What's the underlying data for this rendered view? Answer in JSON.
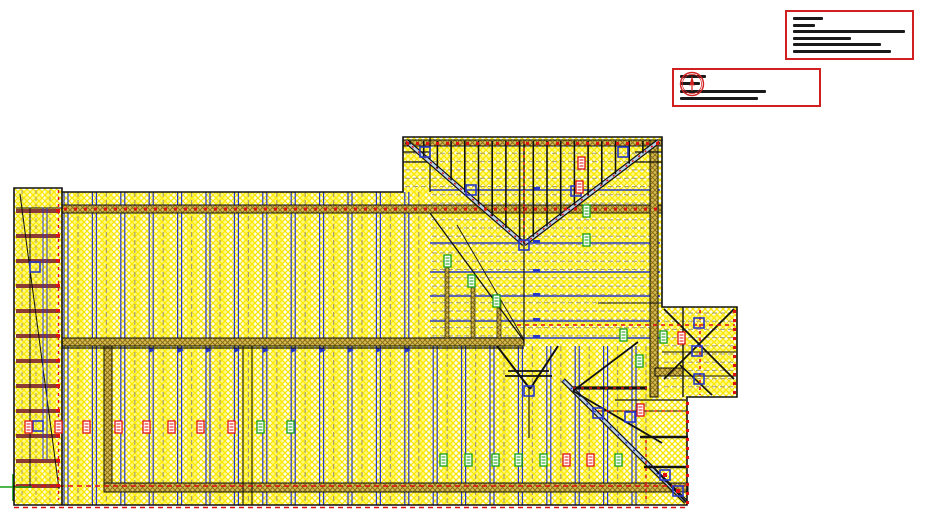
{
  "window": {
    "title": "structural-framing-plan-view"
  },
  "colors": {
    "hatch_yellow": "#f6e400",
    "hatch_bg": "#fffef2",
    "band_yellow": "#fff000",
    "tan_bg": "#d7bc55",
    "tan_line": "#8a7014",
    "maroon": "#8c3a34",
    "joist_blue": "#2838c8",
    "centerline_olive": "#a8a070",
    "accent_red": "#e01010",
    "label_green": "#12a012",
    "titleblock_border": "#d02020",
    "line_black": "#111111",
    "hip_core": "#b9d0e8"
  },
  "titleblock1": {
    "bar_widths": [
      30,
      22,
      112,
      58,
      88,
      98
    ]
  },
  "titleblock2": {
    "bar_widths": [
      26,
      20,
      86,
      78
    ],
    "logo": "compass-tree-logo"
  },
  "drawing": {
    "vfields": [
      {
        "start": 64,
        "step": 28.4,
        "count": 13,
        "yTop": 192,
        "yBot": 505
      },
      {
        "start": 433.2,
        "step": 28.4,
        "count": 8,
        "yTop": 346,
        "yBot": 505
      }
    ],
    "left_strips": {
      "xs": [
        17,
        31,
        45
      ],
      "w": 11,
      "yTop": 190,
      "yBot": 503
    },
    "hfields": [
      {
        "y0": 145,
        "step": 8.3,
        "count": 24,
        "x0": 432,
        "x1": 658
      },
      {
        "y0": 145,
        "step": 8.3,
        "count": 6,
        "x0": 405,
        "x1": 431
      },
      {
        "y0": 313,
        "step": 8.2,
        "count": 10,
        "x0": 664,
        "x1": 734
      }
    ],
    "span_lines_y": [
      190,
      243,
      272,
      296,
      321,
      338
    ],
    "rafters": {
      "x0": 410,
      "step": 13.7,
      "count": 18,
      "yTop": 141,
      "apexX": 524,
      "leftHipX": 406,
      "leftSlope": 0.873,
      "rightHipX": 659,
      "rightSlope": 0.763
    },
    "stairs": {
      "x": 16,
      "w": 44,
      "h": 4,
      "y0": 209,
      "step": 25,
      "count": 12
    },
    "arrow_ticks_x": [
      149,
      178,
      206,
      234,
      263,
      291,
      320,
      348,
      376,
      405
    ],
    "labels": [
      [
        25,
        421,
        "r"
      ],
      [
        55,
        421,
        "r"
      ],
      [
        83,
        421,
        "r"
      ],
      [
        115,
        421,
        "r"
      ],
      [
        143,
        421,
        "r"
      ],
      [
        168,
        421,
        "r"
      ],
      [
        197,
        421,
        "r"
      ],
      [
        228,
        421,
        "r"
      ],
      [
        257,
        421,
        "g"
      ],
      [
        287,
        421,
        "g"
      ],
      [
        440,
        454,
        "g"
      ],
      [
        465,
        454,
        "g"
      ],
      [
        492,
        454,
        "g"
      ],
      [
        515,
        454,
        "g"
      ],
      [
        540,
        454,
        "g"
      ],
      [
        563,
        454,
        "r"
      ],
      [
        587,
        454,
        "r"
      ],
      [
        615,
        454,
        "g"
      ],
      [
        578,
        157,
        "r"
      ],
      [
        576,
        181,
        "r"
      ],
      [
        583,
        205,
        "g"
      ],
      [
        583,
        234,
        "g"
      ],
      [
        444,
        255,
        "g"
      ],
      [
        468,
        275,
        "g"
      ],
      [
        493,
        295,
        "g"
      ],
      [
        620,
        329,
        "g"
      ],
      [
        660,
        331,
        "g"
      ],
      [
        678,
        332,
        "r"
      ],
      [
        636,
        355,
        "g"
      ],
      [
        637,
        404,
        "r"
      ]
    ],
    "squares": [
      [
        420,
        147,
        0
      ],
      [
        466,
        185,
        0
      ],
      [
        571,
        186,
        0
      ],
      [
        618,
        147,
        0
      ],
      [
        519,
        240,
        0
      ],
      [
        30,
        262,
        0
      ],
      [
        694,
        318,
        0
      ],
      [
        692,
        346,
        0
      ],
      [
        694,
        374,
        0
      ],
      [
        593,
        408,
        0
      ],
      [
        625,
        412,
        0
      ],
      [
        660,
        470,
        1
      ],
      [
        673,
        486,
        1
      ],
      [
        524,
        386,
        0
      ],
      [
        33,
        421,
        0
      ]
    ],
    "dot_rows": [
      {
        "x0": 64,
        "y0": 207.5,
        "dx": 10,
        "dy": 0,
        "n": 60,
        "w": 3,
        "h": 3
      },
      {
        "x0": 406,
        "y0": 142,
        "dx": 10,
        "dy": 0,
        "n": 26,
        "w": 3,
        "h": 3
      },
      {
        "x0": 686,
        "y0": 402,
        "dx": 0,
        "dy": 9,
        "n": 12,
        "w": 3,
        "h": 3
      },
      {
        "x0": 733,
        "y0": 310,
        "dx": 0,
        "dy": 9,
        "n": 10,
        "w": 3,
        "h": 3
      },
      {
        "x0": 56,
        "y0": 209,
        "dx": 0,
        "dy": 25,
        "n": 12,
        "w": 4,
        "h": 3
      }
    ]
  }
}
